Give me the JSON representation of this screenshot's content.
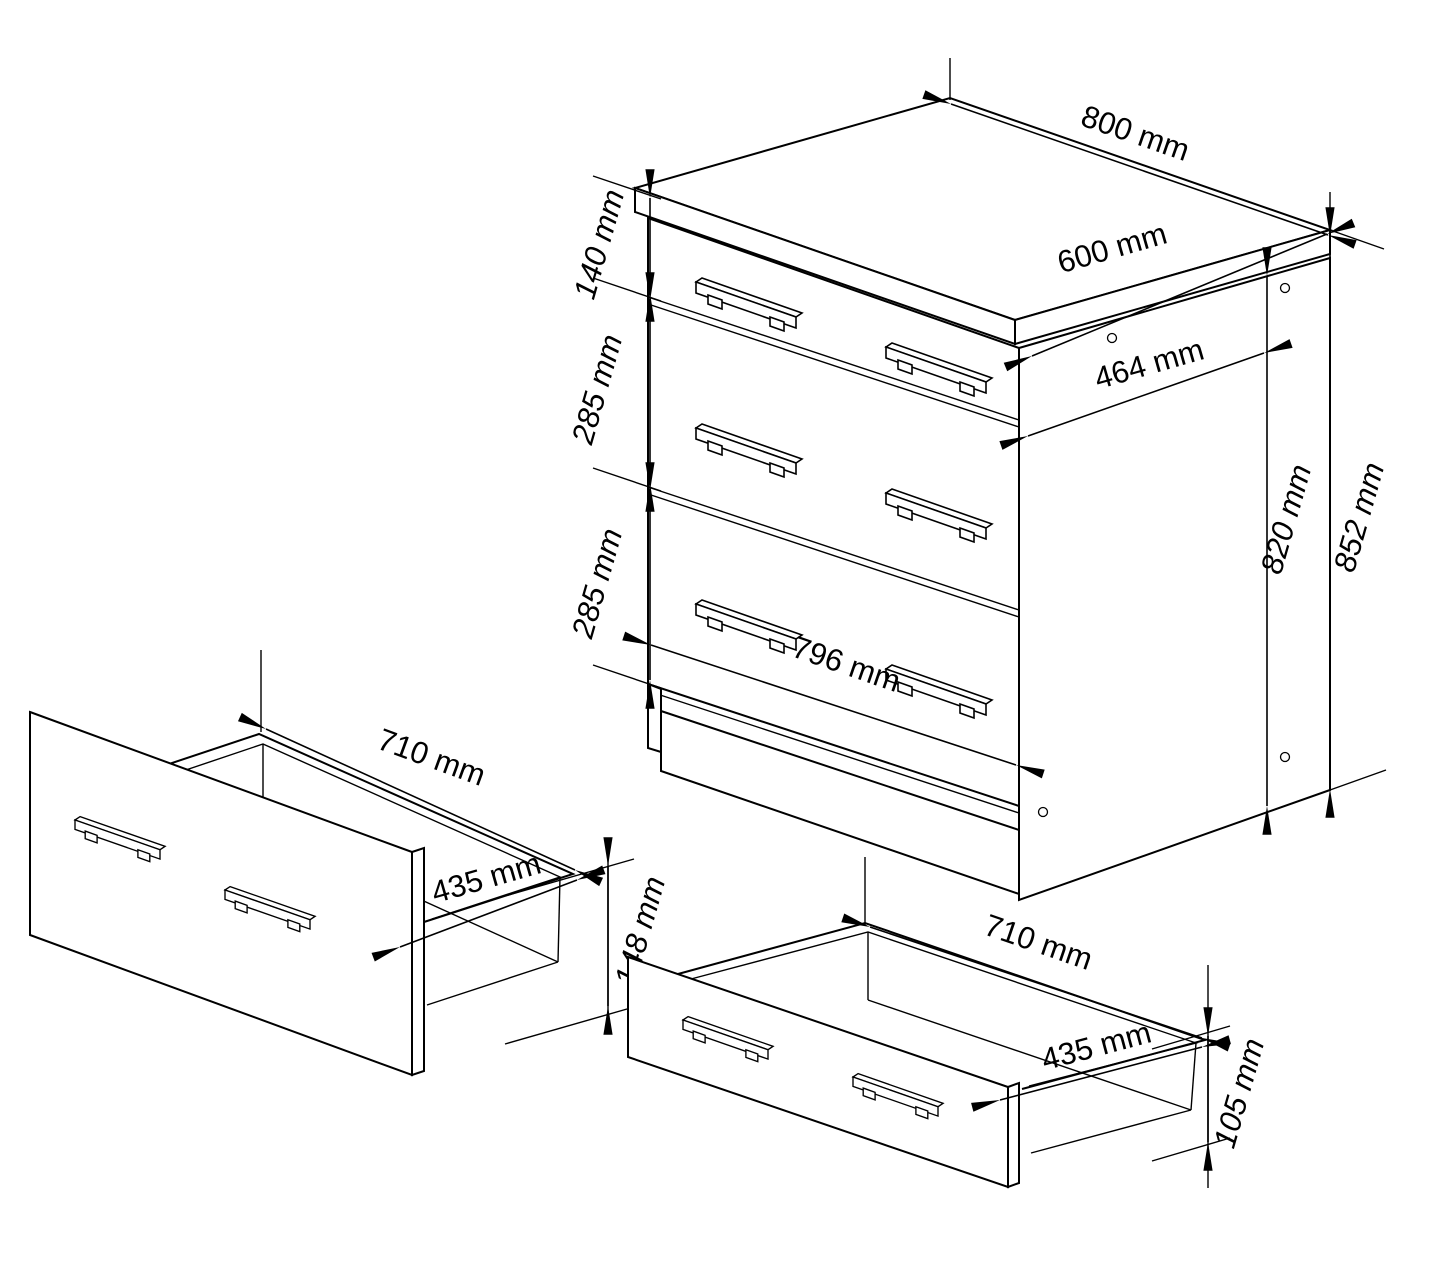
{
  "drawing": {
    "type": "furniture-dimension-diagram",
    "units": "mm",
    "colors": {
      "line": "#000000",
      "background": "#ffffff"
    },
    "cabinet": {
      "description": "three-drawer base cabinet isometric view",
      "dims": {
        "top_width": "800 mm",
        "top_depth": "600 mm",
        "inner_depth": "464 mm",
        "drawer1_front": "140 mm",
        "drawer2_front": "285 mm",
        "drawer3_front": "285 mm",
        "body_height": "820 mm",
        "total_height": "852 mm",
        "front_width": "796 mm"
      }
    },
    "drawer_left": {
      "description": "open drawer detail, tall front",
      "dims": {
        "width": "710 mm",
        "depth": "435 mm",
        "front_height": "148 mm"
      }
    },
    "drawer_right": {
      "description": "open drawer detail, low front",
      "dims": {
        "width": "710 mm",
        "depth": "435 mm",
        "front_height": "105 mm"
      }
    }
  }
}
